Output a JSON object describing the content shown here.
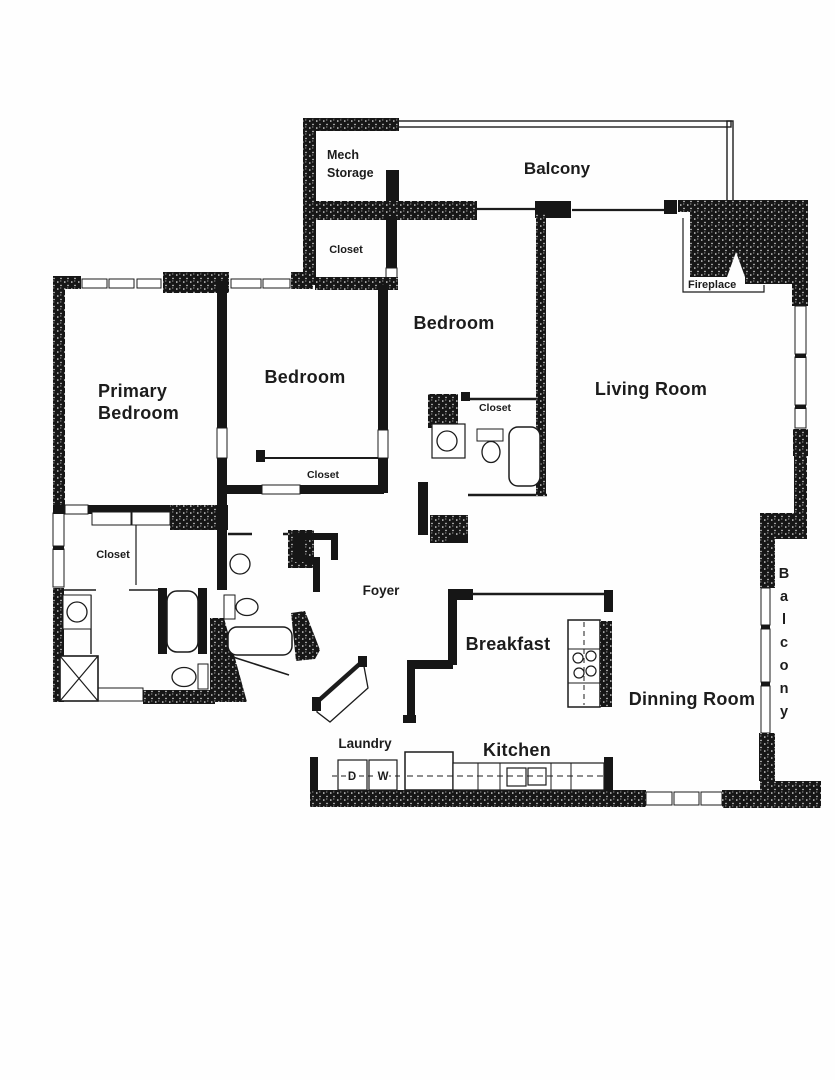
{
  "colors": {
    "ink": "#1c1c1c",
    "wall": "#161616",
    "paper": "#fefefe"
  },
  "labels": {
    "mech_storage_line1": "Mech",
    "mech_storage_line2": "Storage",
    "balcony_top": "Balcony",
    "closet_top": "Closet",
    "primary_line1": "Primary",
    "primary_line2": "Bedroom",
    "bedroom_left": "Bedroom",
    "bedroom_center": "Bedroom",
    "living_room": "Living Room",
    "fireplace": "Fireplace",
    "closet_center_bath": "Closet",
    "closet_bedroom": "Closet",
    "closet_walk_in": "Closet",
    "foyer": "Foyer",
    "breakfast": "Breakfast",
    "dining_room": "Dinning Room",
    "kitchen": "Kitchen",
    "laundry": "Laundry",
    "balcony_right": "Balcony",
    "dryer": "D",
    "washer": "W"
  }
}
